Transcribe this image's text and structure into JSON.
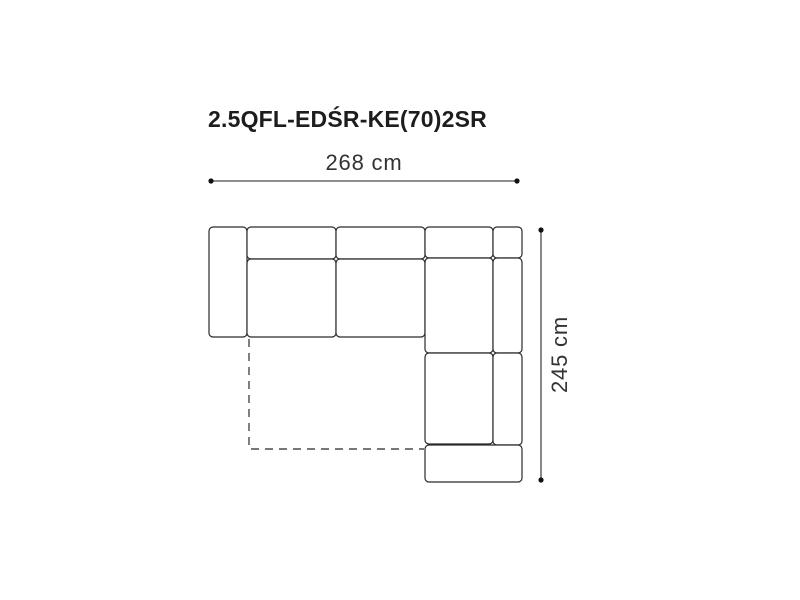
{
  "title": {
    "text": "2.5QFL-EDŚR-KE(70)2SR"
  },
  "dimensions": {
    "width": {
      "label": "268 cm"
    },
    "height": {
      "label": "245 cm"
    }
  },
  "diagram": {
    "type": "sofa-top-view",
    "description": "L-shaped corner sofa top view with dashed fold-out bed outline",
    "colors": {
      "outline": "#2a2a2a",
      "fill": "#ffffff",
      "dimension_line": "#6a6a6a",
      "dimension_dot": "#111111",
      "dashed_line": "#4a4a4a",
      "title_text": "#1d1d1d",
      "dimension_text": "#333333"
    },
    "corner_radius": 4,
    "outline_width": 1.2,
    "pieces": [
      {
        "name": "armrest-left",
        "x": 209,
        "y": 227,
        "w": 38,
        "h": 110
      },
      {
        "name": "backrest-left",
        "x": 247,
        "y": 227,
        "w": 89,
        "h": 32
      },
      {
        "name": "backrest-mid",
        "x": 336,
        "y": 227,
        "w": 89,
        "h": 32
      },
      {
        "name": "backrest-corner",
        "x": 425,
        "y": 227,
        "w": 68,
        "h": 31
      },
      {
        "name": "corner-connector",
        "x": 493,
        "y": 227,
        "w": 29,
        "h": 31
      },
      {
        "name": "seat-left",
        "x": 247,
        "y": 259,
        "w": 89,
        "h": 78
      },
      {
        "name": "seat-mid",
        "x": 336,
        "y": 259,
        "w": 89,
        "h": 78
      },
      {
        "name": "seat-corner",
        "x": 425,
        "y": 258,
        "w": 68,
        "h": 95
      },
      {
        "name": "backrest-right-upper",
        "x": 493,
        "y": 258,
        "w": 29,
        "h": 95
      },
      {
        "name": "seat-right",
        "x": 425,
        "y": 353,
        "w": 68,
        "h": 91
      },
      {
        "name": "backrest-right-lower",
        "x": 493,
        "y": 353,
        "w": 29,
        "h": 92
      },
      {
        "name": "armrest-bottom",
        "x": 425,
        "y": 445,
        "w": 97,
        "h": 37
      }
    ],
    "dashed_bed_outline": {
      "points": "249,339 249,449 424,449",
      "dash_pattern": "8 6",
      "width": 1.4
    },
    "dimension_lines": {
      "horizontal": {
        "x1": 211,
        "x2": 517,
        "y": 181
      },
      "vertical": {
        "x": 541,
        "y1": 230,
        "y2": 480
      },
      "line_width": 1.6,
      "dot_radius": 2.6
    }
  }
}
